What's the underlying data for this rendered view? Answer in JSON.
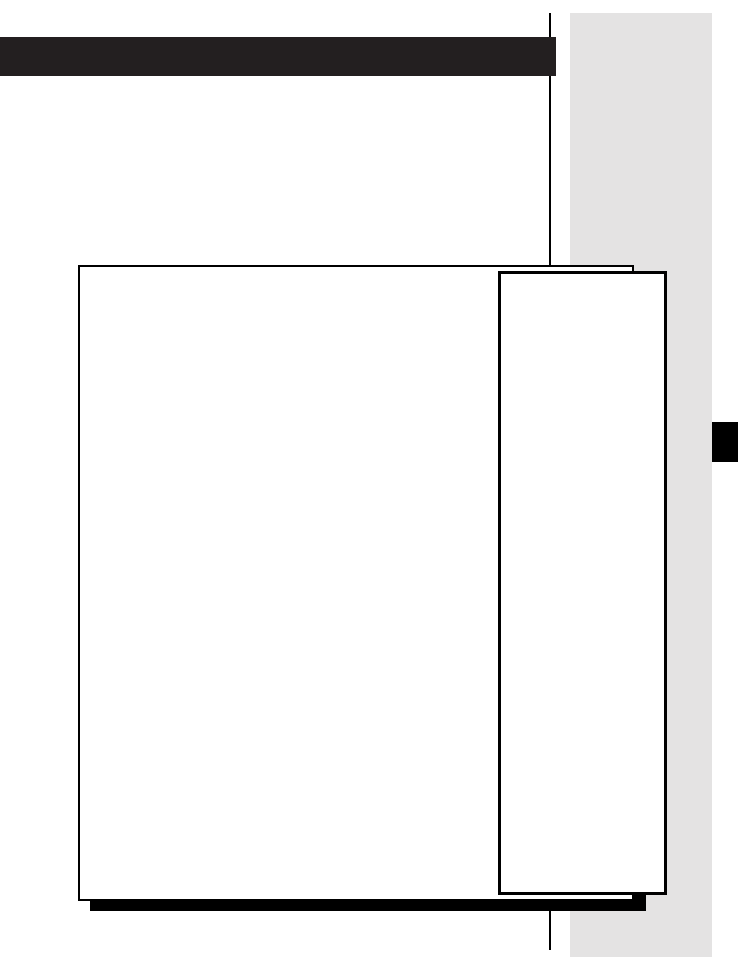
{
  "colors": {
    "page_background": "#ffffff",
    "header_banner": "#231f20",
    "sidebar_panel": "#e4e3e3",
    "column_rule": "#000000",
    "box_shadow": "#000000",
    "content_box_fill": "#ffffff",
    "content_box_border": "#000000",
    "side_note_box_fill": "#ffffff",
    "side_note_box_border": "#000000",
    "section_tab_marker": "#000000"
  }
}
